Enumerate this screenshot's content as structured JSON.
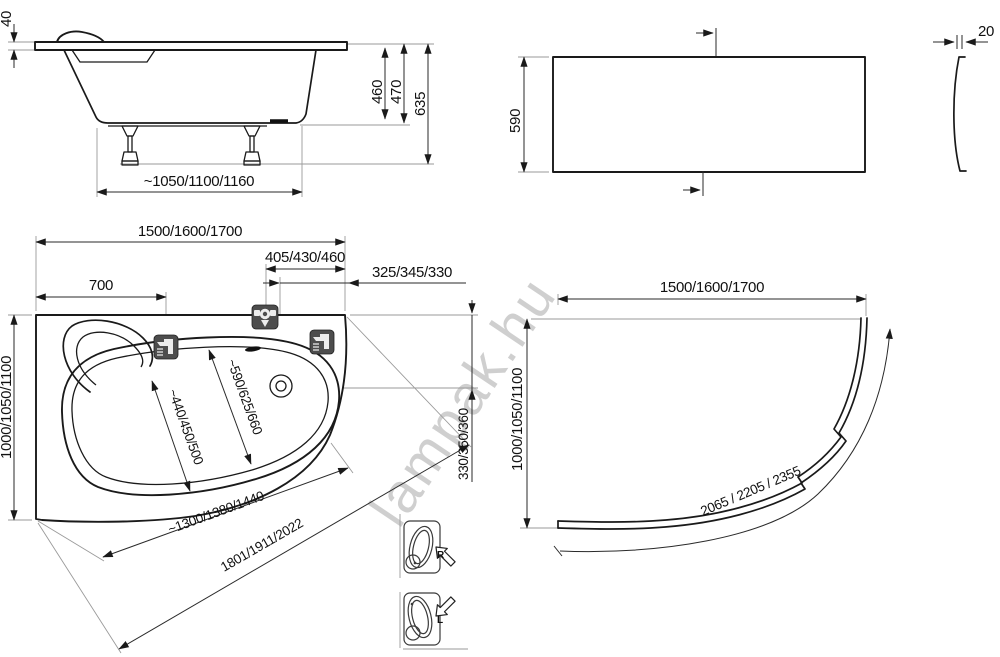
{
  "watermark": "lampak.hu",
  "side_view": {
    "rim_height": "40",
    "inner_depth": "460",
    "shell_height": "470",
    "total_height": "635",
    "leg_spacing": "~1050/1100/1160"
  },
  "front_panel": {
    "height": "590",
    "thickness": "20"
  },
  "top_view": {
    "length": "1500/1600/1700",
    "mixer_offset": "405/430/460",
    "drain_offset": "325/345/330",
    "left_tap_offset": "700",
    "width": "1000/1050/1100",
    "well_width_large": "~590/625/660",
    "well_width_small": "~440/450/500",
    "drain_from_edge": "330/350/360",
    "front_edge_length": "~1300/1380/1440",
    "diagonal_length": "1801/1911/2022"
  },
  "corner_panel": {
    "length": "1500/1600/1700",
    "width": "1000/1050/1100",
    "curve_length": "2065 / 2205 / 2355"
  },
  "orientation": {
    "right_label": "R",
    "left_label": "L"
  },
  "colors": {
    "line": "#1a1a1a",
    "dimension": "#2a2a2a",
    "extension": "#9a9a9a",
    "icon_background": "#4d4d4d",
    "watermark": "#c4c4c4"
  }
}
